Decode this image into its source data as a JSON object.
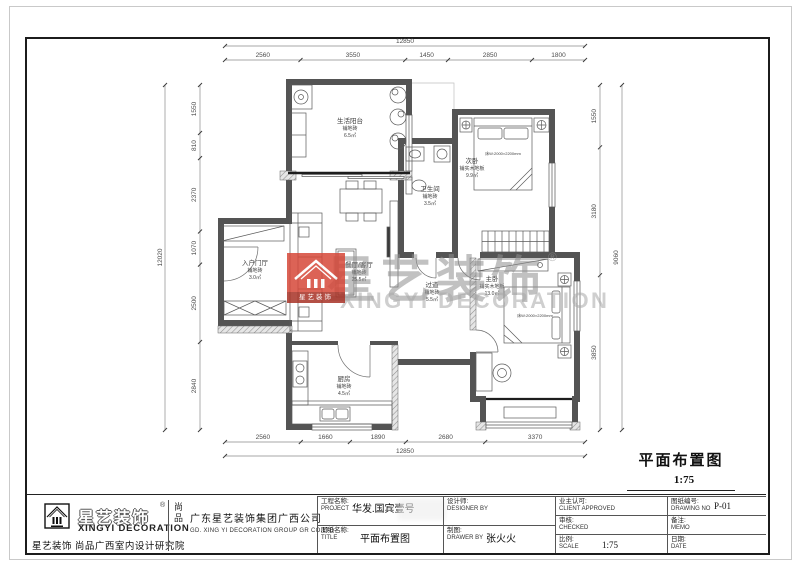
{
  "drawing": {
    "title": "平面布置图",
    "scale": "1:75"
  },
  "watermark": {
    "cn": "星艺装饰",
    "reg": "®",
    "en": "XINGYI DECORATION",
    "logo_text": "星艺装饰"
  },
  "rooms": {
    "balcony": {
      "name": "生活阳台",
      "floor": "铺地砖",
      "area": "6.5㎡"
    },
    "living": {
      "name": "餐厅/客厅",
      "floor": "铺地砖",
      "area": "25.5㎡"
    },
    "entry": {
      "name": "入户门厅",
      "floor": "铺地砖",
      "area": "3.0㎡"
    },
    "kitchen": {
      "name": "厨房",
      "floor": "铺地砖",
      "area": "4.5㎡"
    },
    "bath": {
      "name": "卫生间",
      "floor": "铺地砖",
      "area": "3.5㎡"
    },
    "hall": {
      "name": "过道",
      "floor": "铺地砖",
      "area": "5.5㎡"
    },
    "bedroom2": {
      "name": "次卧",
      "floor": "铺实木地板",
      "area": "9.9㎡",
      "bed": "床W:2000×2200mm"
    },
    "master": {
      "name": "主卧",
      "floor": "铺实木地板",
      "area": "13.0㎡",
      "bed": "床W:2000×2200mm"
    }
  },
  "dims": {
    "top": {
      "total": "12850",
      "segments": [
        "2560",
        "3550",
        "1450",
        "2850",
        "1800"
      ]
    },
    "bottom": {
      "total": "12850",
      "segments": [
        "2560",
        "1660",
        "1890",
        "2680",
        "3370"
      ]
    },
    "left": {
      "total": "12020",
      "segments": [
        "1550",
        "810",
        "2370",
        "1070",
        "2500",
        "2840"
      ]
    },
    "right": {
      "total": "9060",
      "segments": [
        "1550",
        "3180",
        "3850"
      ]
    }
  },
  "titleblock": {
    "logo": {
      "cn": "星艺装饰",
      "reg": "®",
      "en": "XINGYI DECORATION",
      "caption": "星艺装饰 尚品广西室内设计研究院",
      "shangpin": "尚品",
      "company_cn": "广东星艺装饰集团广西公司",
      "company_en": "GD. XING YI DECORATION GROUP GR CO.LTD"
    },
    "project": {
      "label": "工程名称:",
      "en": "PROJECT",
      "value": "华发.国宾壹号"
    },
    "designer": {
      "label": "设计师:",
      "en": "DESIGNER BY"
    },
    "sheet": {
      "label": "图纸名称:",
      "en": "TITLE",
      "value": "平面布置图"
    },
    "drawer": {
      "label": "制图:",
      "en": "DRAWER BY",
      "value": "张火火"
    },
    "client": {
      "label": "业主认可:",
      "en": "CLIENT APPROVED"
    },
    "checked": {
      "label": "审核:",
      "en": "CHECKED"
    },
    "scale": {
      "label": "比例:",
      "en": "SCALE",
      "value": "1:75"
    },
    "drawing_no": {
      "label": "图纸编号:",
      "en": "DRAWING NO",
      "value": "P-01"
    },
    "memo": {
      "label": "备注:",
      "en": "MEMO"
    },
    "date": {
      "label": "日期:",
      "en": "DATE"
    }
  }
}
